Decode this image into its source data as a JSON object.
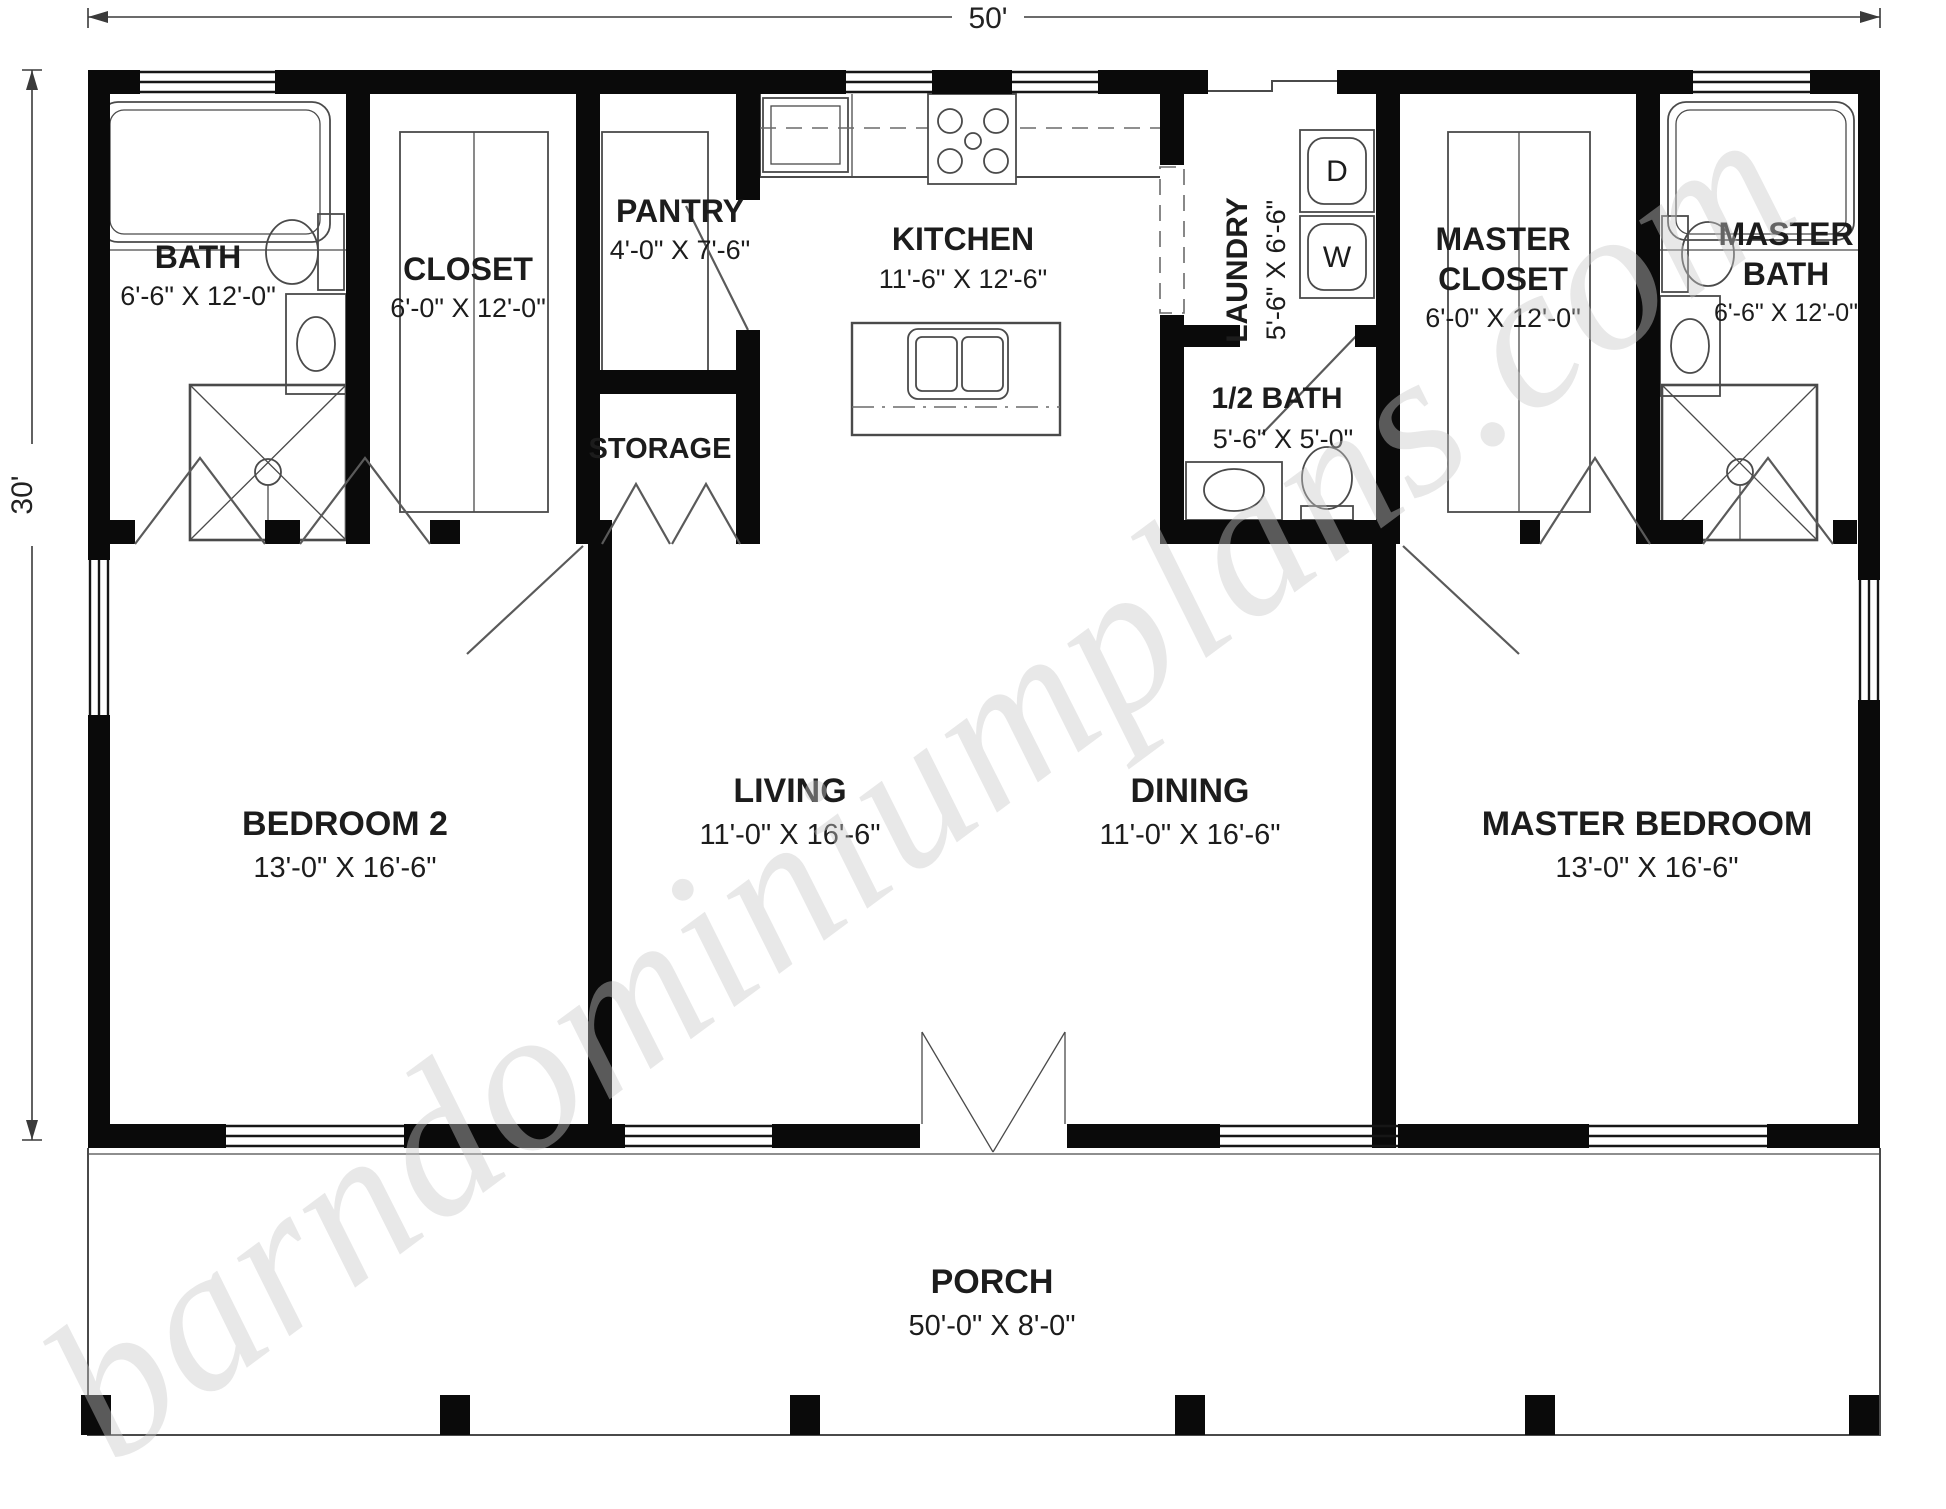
{
  "watermark": "barndominiumplans.com",
  "dimensions": {
    "overall_width": "50'",
    "overall_height": "30'"
  },
  "labels": {
    "bath": {
      "name": "BATH",
      "dims": "6'-6\" X 12'-0\""
    },
    "closet": {
      "name": "CLOSET",
      "dims": "6'-0\" X 12'-0\""
    },
    "pantry": {
      "name": "PANTRY",
      "dims": "4'-0\" X 7'-6\""
    },
    "kitchen": {
      "name": "KITCHEN",
      "dims": "11'-6\" X 12'-6\""
    },
    "laundry": {
      "name": "LAUNDRY",
      "dims": "5'-6\" X 6'-6\""
    },
    "half_bath": {
      "name": "1/2 BATH",
      "dims": "5'-6\" X 5'-0\""
    },
    "storage": {
      "name": "STORAGE"
    },
    "master_closet": {
      "line1": "MASTER",
      "line2": "CLOSET",
      "dims": "6'-0\" X 12'-0\""
    },
    "master_bath": {
      "line1": "MASTER",
      "line2": "BATH",
      "dims": "6'-6\" X 12'-0\""
    },
    "bedroom2": {
      "name": "BEDROOM 2",
      "dims": "13'-0\" X 16'-6\""
    },
    "living": {
      "name": "LIVING",
      "dims": "11'-0\" X 16'-6\""
    },
    "dining": {
      "name": "DINING",
      "dims": "11'-0\" X 16'-6\""
    },
    "master_bedroom": {
      "name": "MASTER BEDROOM",
      "dims": "13'-0\" X 16'-6\""
    },
    "porch": {
      "name": "PORCH",
      "dims": "50'-0\" X 8'-0\""
    }
  },
  "appliances": {
    "dryer": "D",
    "washer": "W"
  }
}
